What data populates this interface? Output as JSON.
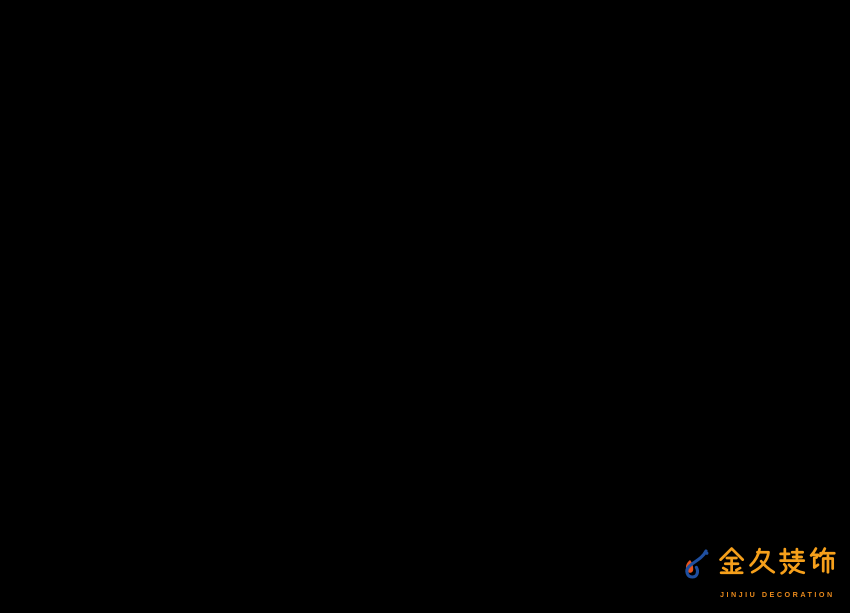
{
  "canvas": {
    "width": 850,
    "height": 613,
    "background": "#000000"
  },
  "brand": {
    "logo_chinese": "金久装饰",
    "logo_english": "JINJIU DECORATION",
    "chinese_color": "#F6A01B",
    "english_color": "#E8891B",
    "mark_blue": "#1F4FA0",
    "mark_orange": "#E8541E"
  },
  "render": {
    "type": "3D isometric office interior rendering",
    "view": "top-down axonometric on black background",
    "areas": [
      "executive office with glass-door bookcase, desk and monitor",
      "inner office with wall painting, wood shelf, plant and two beige lounge chairs",
      "open-plan office with four wood workstation clusters, monitors, striped binders and white task chairs",
      "tall white storage cabinet with wood planter at curtain wall",
      "white slatted partition panels with hanging green plants",
      "conference room with long white table, wood runner, blue chairs and glowing cyan laptop",
      "media cabinet with cyan LED strip and potted palm",
      "white feature wall with blue company lettering",
      "reception with curved white counter and blue logo chip",
      "entrance with dark framed glass doors",
      "exterior terrace row of beige chairs behind curtain wall",
      "thick white exterior wall with stepped profile at right"
    ],
    "wall_sign": {
      "legible": false,
      "description": "blue Chinese company-name lettering with square logo mark on white feature wall",
      "color": "#2B3F9E"
    },
    "palette": {
      "carpet": "#49516B",
      "carpet_dark": "#3A4156",
      "wood": "#C9A878",
      "wood_dark": "#A8824E",
      "white_wall": "#F2F3F5",
      "glass_frame": "#343941",
      "glass_tint": "#4E5866",
      "conference_chair_blue": "#2E55CB",
      "task_chair": "#E2E4E6",
      "exec_chair": "#2B2E33",
      "lounge_chair_beige": "#D9C4A4",
      "led_strip_cyan": "#35E0F0",
      "plant_green": "#3E7A3C",
      "monitor": "#15181D",
      "binder_red": "#CF4A55",
      "binder_green": "#3F7D4E",
      "door_wood": "#8A6848",
      "handle_gold": "#C9A24C",
      "sign_blue": "#2B3F9E"
    }
  }
}
